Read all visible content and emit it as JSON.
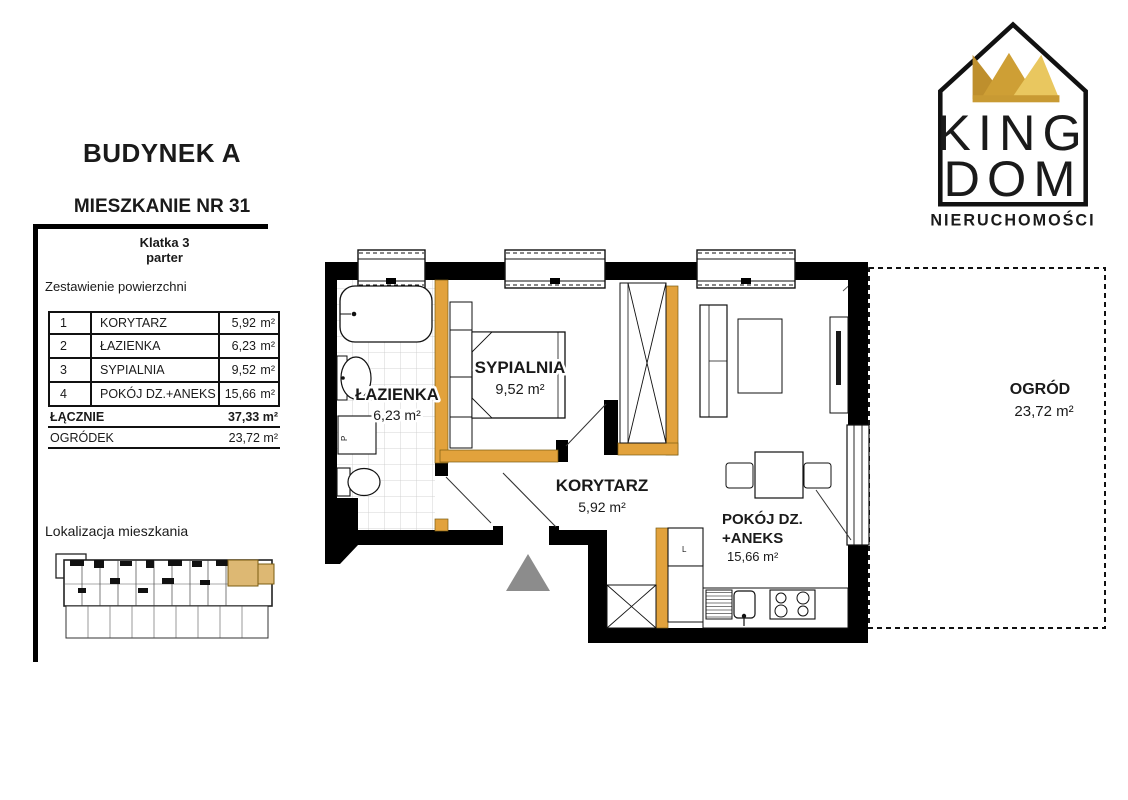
{
  "header": {
    "building_title": "BUDYNEK A",
    "apartment_title": "MIESZKANIE NR 31",
    "staircase": "Klatka 3",
    "floor": "parter"
  },
  "logo": {
    "king": "KING",
    "dom": "DOM",
    "subtitle": "NIERUCHOMOŚCI",
    "crown_colors": [
      "#BE8F2D",
      "#CE9F35",
      "#E9C75F"
    ]
  },
  "info": {
    "table_title": "Zestawienie powierzchni",
    "rows": [
      {
        "no": "1",
        "name": "KORYTARZ",
        "value": "5,92",
        "unit": "m²"
      },
      {
        "no": "2",
        "name": "ŁAZIENKA",
        "value": "6,23",
        "unit": "m²"
      },
      {
        "no": "3",
        "name": "SYPIALNIA",
        "value": "9,52",
        "unit": "m²"
      },
      {
        "no": "4",
        "name": "POKÓJ DZ.+ANEKS",
        "value": "15,66",
        "unit": "m²"
      }
    ],
    "total_label": "ŁĄCZNIE",
    "total_value": "37,33 m²",
    "garden_label": "OGRÓDEK",
    "garden_value": "23,72 m²",
    "location_label": "Lokalizacja mieszkania"
  },
  "plan": {
    "bathroom": {
      "name": "ŁAZIENKA",
      "area": "6,23 m²"
    },
    "bedroom": {
      "name": "SYPIALNIA",
      "area": "9,52 m²"
    },
    "corridor": {
      "name": "KORYTARZ",
      "area": "5,92 m²"
    },
    "living": {
      "name": "POKÓJ DZ.",
      "name2": "+ANEKS",
      "area": "15,66 m²"
    },
    "garden": {
      "name": "OGRÓD",
      "area": "23,72 m²"
    },
    "washer_label": "P",
    "fridge_label": "L",
    "colors": {
      "accent_wall": "#E2A23C",
      "highlight_unit": "#DDB873",
      "entrance_arrow": "#8C8C8C",
      "wall": "#000000"
    }
  }
}
